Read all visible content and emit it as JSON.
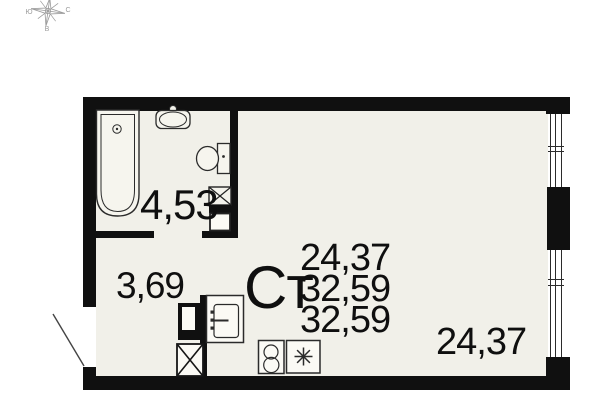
{
  "plan_type": "studio-apartment-floor-plan",
  "colors": {
    "wall": "#101010",
    "floor": "#f1f0e9",
    "fixture_line": "#2b2b2b",
    "text": "#0f0f0f",
    "compass": "#9a9a9a"
  },
  "compass": {
    "left": "Ю",
    "right": "С",
    "bottom": "В"
  },
  "rooms": {
    "bathroom": {
      "area": "4,53"
    },
    "hallway": {
      "area": "3,69"
    },
    "living": {
      "label": "Ст",
      "area_stack": [
        "24,37",
        "32,59",
        "32,59"
      ],
      "floor_area": "24,37"
    }
  },
  "icons": {
    "vent_shaft": "crossed-box-icon",
    "appliance": "asterisk-icon",
    "north_arrow": "compass-rose-icon"
  }
}
